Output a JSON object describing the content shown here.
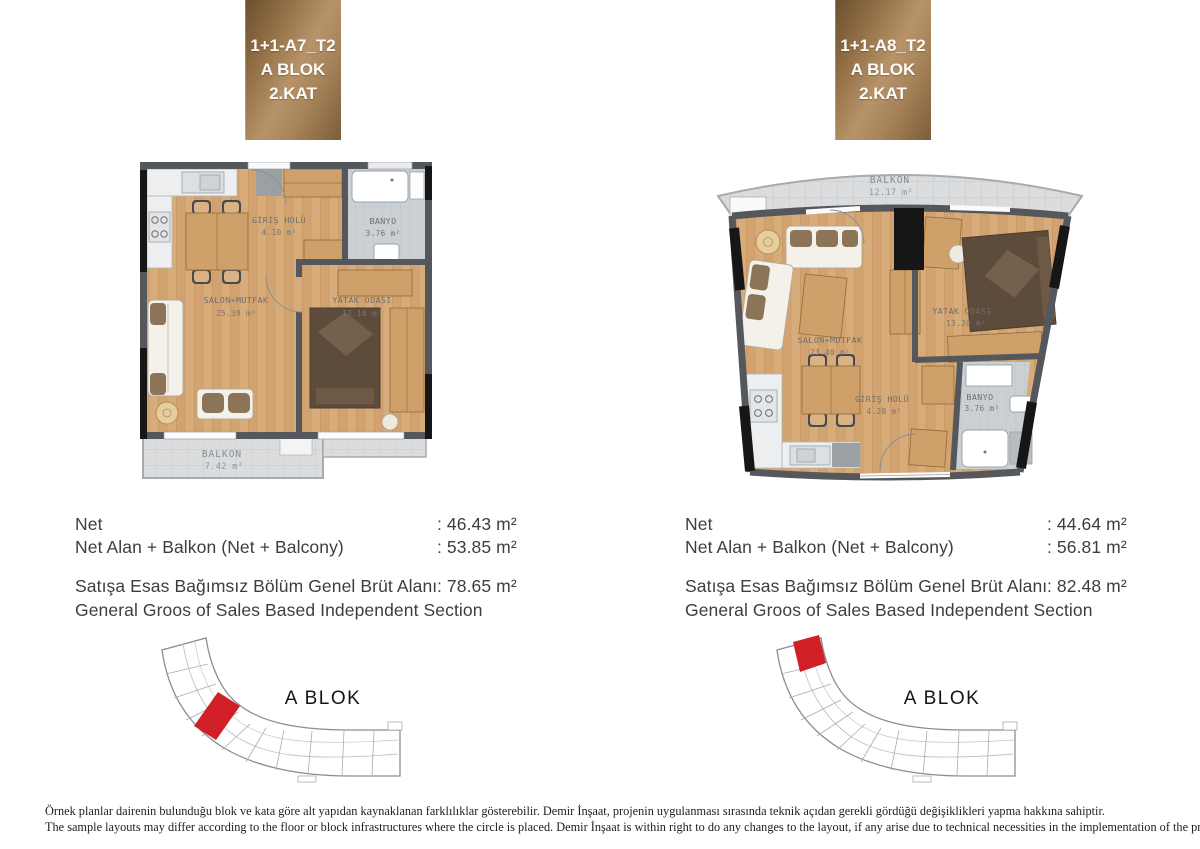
{
  "colors": {
    "tag_bronze_dark": "#6b4f2e",
    "tag_bronze_light": "#b7936a",
    "highlight_red": "#d01f26",
    "wood_floor": "#d8ac7a",
    "wall_gray": "#54575b",
    "wall_black": "#161616",
    "balcony_tile": "#dadcdd",
    "bath_tile": "#cbd0d4",
    "text_dark": "#3e3e3e"
  },
  "units": [
    {
      "id": "A7",
      "tag": {
        "line1": "1+1-A7_T2",
        "line2": "A BLOK",
        "line3": "2.KAT"
      },
      "plan": {
        "giris_holu_name": "GİRİŞ HOLÜ",
        "giris_holu_area": "4.10 m²",
        "banyo_name": "BANYO",
        "banyo_area": "3.76 m²",
        "salon_name": "SALON+MUTFAK",
        "salon_area": "25.39 m²",
        "yatak_name": "YATAK ODASI",
        "yatak_area": "13.18 m²",
        "balkon_name": "BALKON",
        "balkon_area": "7.42 m²"
      },
      "measurements": {
        "net_label": "Net",
        "net_value": ": 46.43 m²",
        "net_balcony_label": "Net Alan + Balkon (Net + Balcony)",
        "net_balcony_value": ": 53.85 m²",
        "gross_label_tr": "Satışa Esas Bağımsız Bölüm Genel Brüt Alanı",
        "gross_value": ": 78.65 m²",
        "gross_label_en": "General Groos of Sales Based Independent Section"
      },
      "site": {
        "label": "A BLOK",
        "highlighted_unit": "left-middle"
      }
    },
    {
      "id": "A8",
      "tag": {
        "line1": "1+1-A8_T2",
        "line2": "A BLOK",
        "line3": "2.KAT"
      },
      "plan": {
        "giris_holu_name": "GİRİŞ HOLÜ",
        "giris_holu_area": "4.28 m²",
        "banyo_name": "BANYO",
        "banyo_area": "3.76 m²",
        "salon_name": "SALON+MUTFAK",
        "salon_area": "23.40 m²",
        "yatak_name": "YATAK ODASI",
        "yatak_area": "13.20 m²",
        "balkon_name": "BALKON",
        "balkon_area": "12.17 m²"
      },
      "measurements": {
        "net_label": "Net",
        "net_value": ": 44.64 m²",
        "net_balcony_label": "Net Alan + Balkon (Net + Balcony)",
        "net_balcony_value": ": 56.81 m²",
        "gross_label_tr": "Satışa Esas Bağımsız Bölüm Genel Brüt Alanı",
        "gross_value": ": 82.48 m²",
        "gross_label_en": "General Groos of Sales Based Independent Section"
      },
      "site": {
        "label": "A BLOK",
        "highlighted_unit": "top-left"
      }
    }
  ],
  "footer": {
    "line_tr": "Örnek planlar dairenin bulunduğu blok ve kata göre alt yapıdan kaynaklanan farklılıklar gösterebilir. Demir İnşaat, projenin uygulanması sırasında teknik açıdan gerekli gördüğü değişiklikleri yapma hakkına sahiptir.",
    "line_en": "The sample layouts may differ according to the floor or block infrastructures where the circle is placed. Demir İnşaat is within right to do any changes to the layout, if any arise due to technical necessities in the implementation of the project."
  }
}
